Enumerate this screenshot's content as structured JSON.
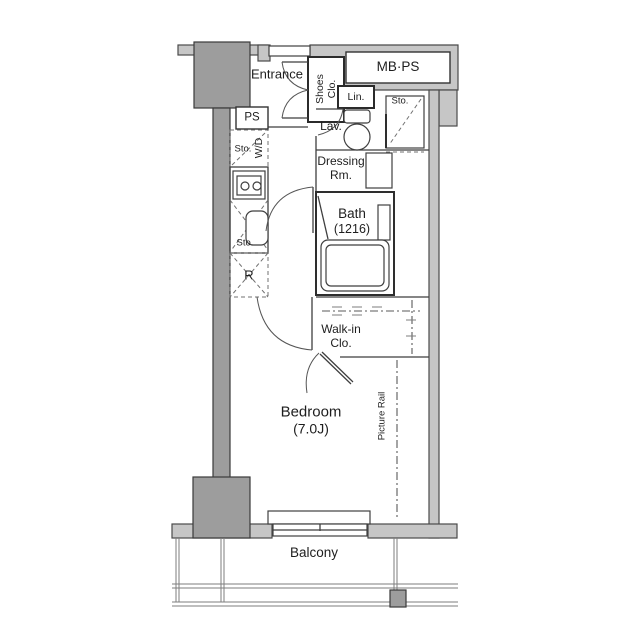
{
  "plan": {
    "type": "apartment-floor-plan",
    "labels": {
      "entrance": "Entrance",
      "shoes_closet": {
        "line1": "Shoes",
        "line2": "Clo."
      },
      "meter_box": "MB·PS",
      "linen": "Lin.",
      "lavatory": "Lav.",
      "storage_lavatory": "Sto.",
      "pipe_space": "PS",
      "storage_kitchen": "Sto.",
      "washer_dryer": "W/D",
      "storage_sink": "Sto.",
      "refrigerator": "R",
      "dressing_room": {
        "line1": "Dressing",
        "line2": "Rm."
      },
      "bath": {
        "line1": "Bath",
        "line2": "(1216)"
      },
      "walk_in_closet": {
        "line1": "Walk-in",
        "line2": "Clo."
      },
      "bedroom": {
        "line1": "Bedroom",
        "line2": "(7.0J)"
      },
      "picture_rail": "Picture Rail",
      "balcony": "Balcony"
    },
    "colors": {
      "wall_light": "#c6c6c6",
      "wall_dark": "#9d9d9d",
      "line": "#3f3f3f",
      "text": "#1e1e1e",
      "background": "#ffffff"
    }
  }
}
